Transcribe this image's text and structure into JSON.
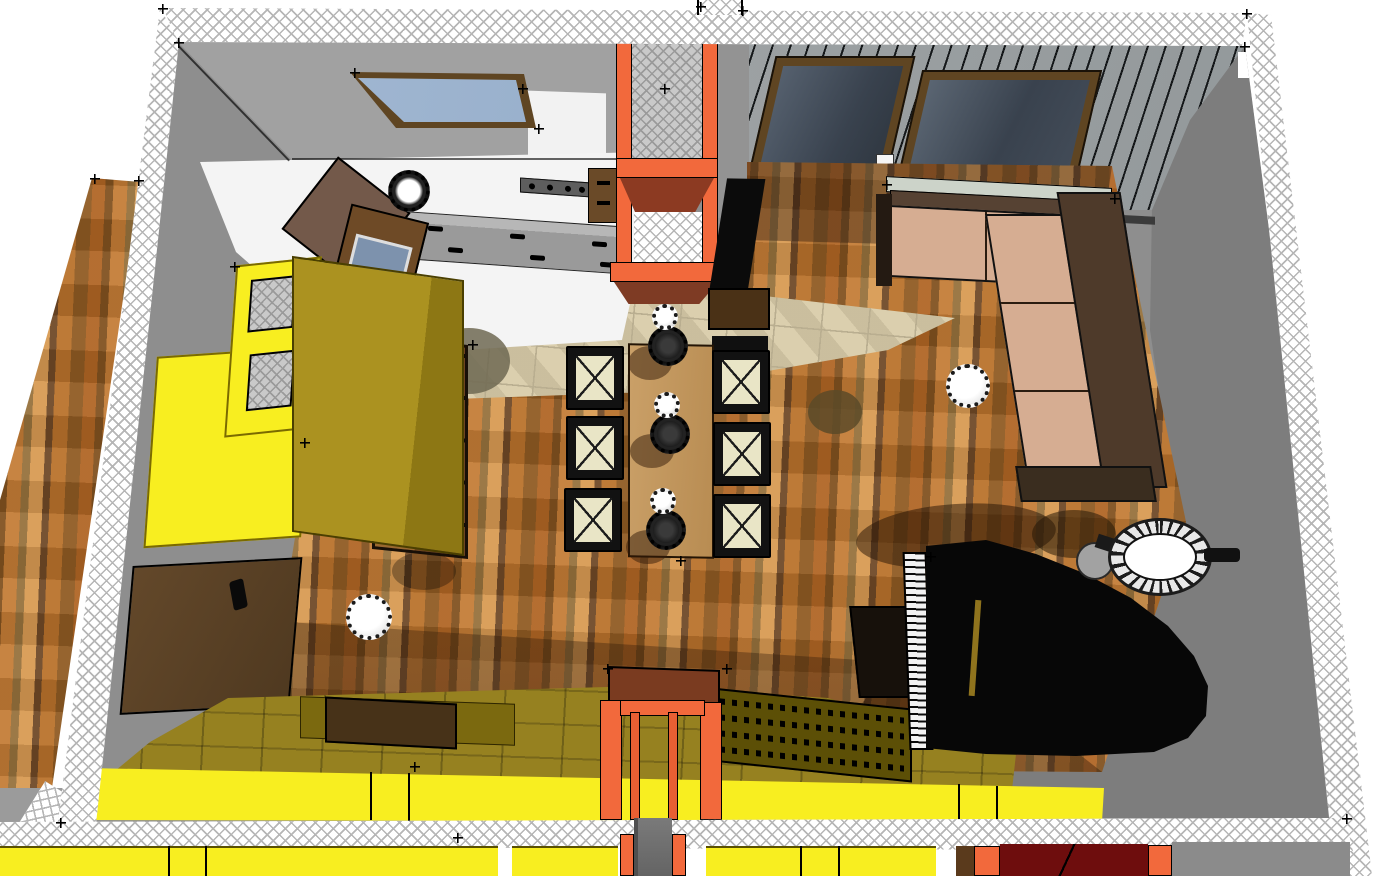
{
  "palette": {
    "hatch_line": "#b6b6b6",
    "floor_gray": "#8e8e8e",
    "wall_gray_north": "#a1a1a1",
    "wall_gray_east": "#7d7d7d",
    "white_floor": "#f4f4f4",
    "tile_base": "#dbcfae",
    "tile_line": "#b9ae90",
    "orange": "#f2693c",
    "brick_red": "#8c3a22",
    "maroon": "#6e0d0d",
    "yellow": "#f8ee20",
    "olive": "#a3891b",
    "olive_dark": "#7b690f",
    "olive_deep": "#5c4f06",
    "sofa_tan": "#d6ad92",
    "sofa_brown": "#4e3a2a",
    "sill_green": "#ccd3c9",
    "table_wood": "#caa068",
    "seat_cream": "#e9e5c6",
    "piano_black": "#070707",
    "glass_sky": "#8fa8c8",
    "glass_window": "#49525e",
    "frame_brown": "#5f4522",
    "console_brown": "#8a5b2e",
    "door_brown": "#5d4426",
    "wood_plank_light": "#d89a52",
    "wood_plank_dark": "#6f4826"
  },
  "objects": [
    {
      "name": "north-wall",
      "material": "wall_gray_north"
    },
    {
      "name": "east-wall",
      "material": "wall_gray_east"
    },
    {
      "name": "south-wall",
      "material": "yellow"
    },
    {
      "name": "west-wall",
      "material": "floor_gray"
    },
    {
      "name": "wall-section-hatch",
      "material": "hatch_line"
    },
    {
      "name": "outside-wood-floor",
      "material": "wood_plank_light"
    },
    {
      "name": "wood-floor",
      "material": "wood_plank_light"
    },
    {
      "name": "travertine-tile-floor",
      "material": "tile_base"
    },
    {
      "name": "kitchen-white-floor",
      "material": "white_floor"
    },
    {
      "name": "skylight",
      "material": "glass_sky"
    },
    {
      "name": "slat-ceiling",
      "material": "wall_gray_east"
    },
    {
      "name": "window-a",
      "material": "glass_window"
    },
    {
      "name": "window-b",
      "material": "glass_window"
    },
    {
      "name": "window-bench",
      "material": "wall_gray_east"
    },
    {
      "name": "fireplace-chimney",
      "material": "orange"
    },
    {
      "name": "tv",
      "material": "piano_black"
    },
    {
      "name": "tv-console",
      "material": "door_brown"
    },
    {
      "name": "sectional-sofa",
      "material": "sofa_tan"
    },
    {
      "name": "dining-table",
      "material": "table_wood"
    },
    {
      "name": "dining-chairs",
      "count": 6,
      "material": "seat_cream"
    },
    {
      "name": "pendant-lamps-over-table",
      "count": 3,
      "material": "piano_black"
    },
    {
      "name": "pendant-lamp-door",
      "material": "white_floor"
    },
    {
      "name": "pendant-lamp-living",
      "material": "white_floor"
    },
    {
      "name": "kitchen-drawer-bank",
      "material": "floor_gray"
    },
    {
      "name": "wall-oven",
      "material": "frame_brown"
    },
    {
      "name": "prep-table",
      "material": "door_brown"
    },
    {
      "name": "ornate-pan",
      "material": "piano_black"
    },
    {
      "name": "yellow-room-divider",
      "material": "yellow"
    },
    {
      "name": "olive-wardrobe",
      "material": "olive"
    },
    {
      "name": "console-table",
      "material": "console_brown"
    },
    {
      "name": "wood-door",
      "material": "door_brown"
    },
    {
      "name": "desk-surface",
      "material": "olive"
    },
    {
      "name": "keyboard-shelf",
      "material": "olive_deep"
    },
    {
      "name": "south-doorway",
      "material": "orange"
    },
    {
      "name": "grand-piano",
      "material": "piano_black"
    },
    {
      "name": "piano-bench",
      "material": "piano_black"
    },
    {
      "name": "lounge-chair",
      "material": "white_floor"
    },
    {
      "name": "side-table",
      "material": "floor_gray"
    },
    {
      "name": "adjacent-room-strip",
      "material": "yellow"
    }
  ]
}
